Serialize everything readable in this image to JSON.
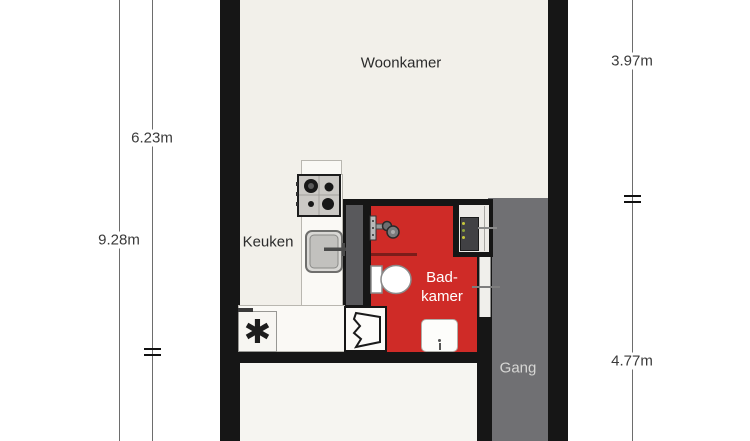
{
  "plan": {
    "rooms": {
      "woonkamer": {
        "label": "Woonkamer"
      },
      "keuken": {
        "label": "Keuken"
      },
      "badkamer": {
        "label_line1": "Bad-",
        "label_line2": "kamer"
      },
      "gang": {
        "label": "Gang"
      }
    },
    "dimensions": {
      "left_total_height": "9.28m",
      "left_upper_height": "6.23m",
      "right_upper_height": "3.97m",
      "right_lower_height": "4.77m"
    },
    "symbols": {
      "freezer_asterisk": "✱"
    },
    "colors": {
      "bathroom_red": "#cf2b27",
      "hallway_gray": "#707073",
      "shaft_gray": "#59595c",
      "wall_black": "#161616",
      "floor_cream": "#f2f0ea"
    }
  }
}
